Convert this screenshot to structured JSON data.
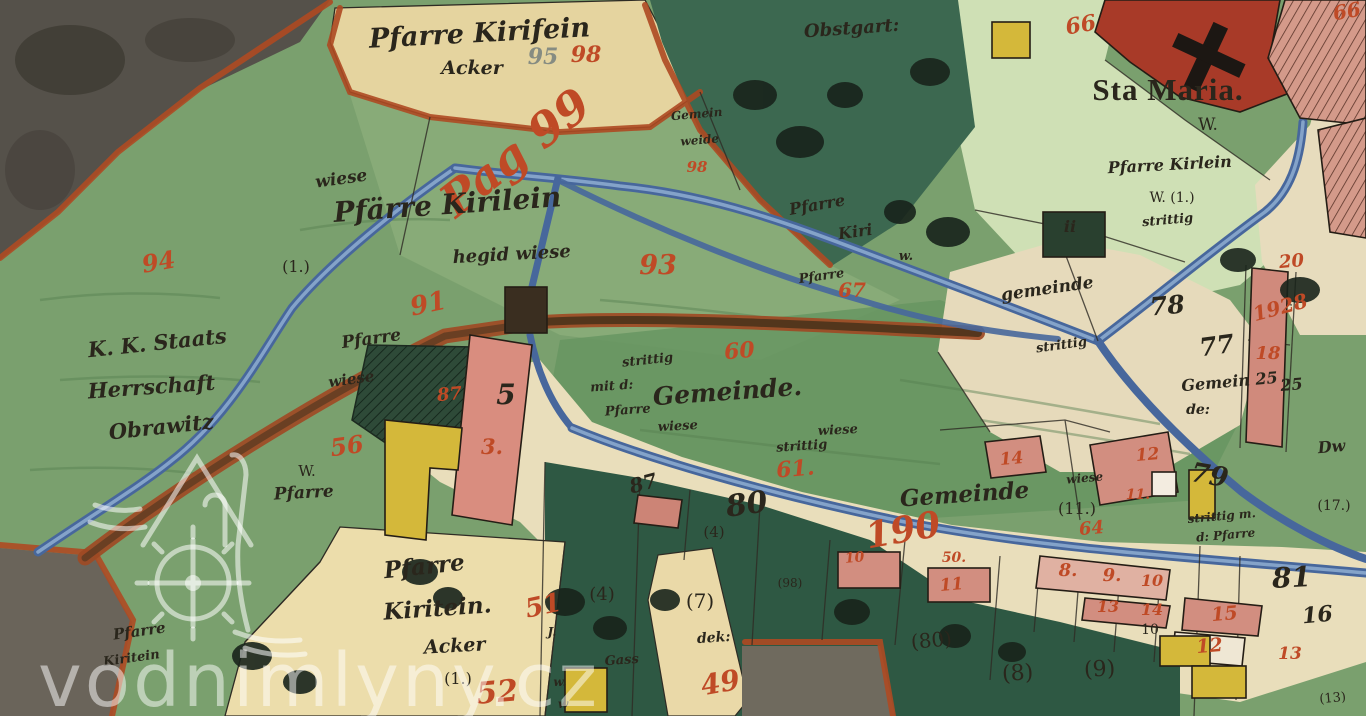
{
  "watermark": {
    "text": "vodnimlyny.cz"
  },
  "colors": {
    "ink": "#2a261c",
    "red": "#bf4a26",
    "gray": "#868c82",
    "white": "rgba(255,255,255,0.55)"
  },
  "labels": [
    {
      "t": "Pfarre Kirifein",
      "x": 480,
      "y": 42,
      "s": 27,
      "c": "ink",
      "r": -3,
      "f": "h"
    },
    {
      "t": "Acker",
      "x": 472,
      "y": 74,
      "s": 19,
      "c": "ink",
      "r": 0,
      "f": "h"
    },
    {
      "t": "95",
      "x": 543,
      "y": 64,
      "s": 22,
      "c": "gray",
      "r": 0,
      "f": "h"
    },
    {
      "t": "98",
      "x": 586,
      "y": 62,
      "s": 22,
      "c": "red",
      "r": 0,
      "f": "h"
    },
    {
      "t": "Obstgart:",
      "x": 852,
      "y": 34,
      "s": 18,
      "c": "ink",
      "r": -4,
      "f": "h"
    },
    {
      "t": "Gemein",
      "x": 697,
      "y": 118,
      "s": 12,
      "c": "ink",
      "r": -5,
      "f": "h"
    },
    {
      "t": "weide",
      "x": 700,
      "y": 144,
      "s": 12,
      "c": "ink",
      "r": -5,
      "f": "h"
    },
    {
      "t": "98",
      "x": 697,
      "y": 172,
      "s": 15,
      "c": "red",
      "r": 0,
      "f": "h"
    },
    {
      "t": "Pag 99",
      "x": 525,
      "y": 165,
      "s": 46,
      "c": "red",
      "r": -38,
      "f": "h"
    },
    {
      "t": "Sta Maria.",
      "x": 1168,
      "y": 100,
      "s": 31,
      "c": "ink",
      "r": 0,
      "f": "t"
    },
    {
      "t": "W.",
      "x": 1208,
      "y": 130,
      "s": 17,
      "c": "ink",
      "r": 0,
      "f": "p"
    },
    {
      "t": "Pfarre Kirlein",
      "x": 1170,
      "y": 170,
      "s": 16,
      "c": "ink",
      "r": -3,
      "f": "h"
    },
    {
      "t": "W. (1.)",
      "x": 1172,
      "y": 202,
      "s": 14,
      "c": "ink",
      "r": 0,
      "f": "p"
    },
    {
      "t": "strittig",
      "x": 1168,
      "y": 224,
      "s": 13,
      "c": "ink",
      "r": -5,
      "f": "h"
    },
    {
      "t": "ii",
      "x": 1070,
      "y": 232,
      "s": 16,
      "c": "ink",
      "r": 0,
      "f": "b"
    },
    {
      "t": "wiese",
      "x": 342,
      "y": 184,
      "s": 17,
      "c": "ink",
      "r": -8,
      "f": "h"
    },
    {
      "t": "Pfärre Kirilein",
      "x": 448,
      "y": 214,
      "s": 28,
      "c": "ink",
      "r": -4,
      "f": "h"
    },
    {
      "t": "(1.)",
      "x": 296,
      "y": 272,
      "s": 16,
      "c": "ink",
      "r": 0,
      "f": "p"
    },
    {
      "t": "hegid wiese",
      "x": 512,
      "y": 260,
      "s": 18,
      "c": "ink",
      "r": -3,
      "f": "h"
    },
    {
      "t": "93",
      "x": 658,
      "y": 274,
      "s": 27,
      "c": "red",
      "r": 0,
      "f": "h"
    },
    {
      "t": "Pfarre",
      "x": 818,
      "y": 210,
      "s": 16,
      "c": "ink",
      "r": -10,
      "f": "h"
    },
    {
      "t": "Kiri",
      "x": 856,
      "y": 237,
      "s": 16,
      "c": "ink",
      "r": -8,
      "f": "h"
    },
    {
      "t": "w.",
      "x": 906,
      "y": 260,
      "s": 13,
      "c": "ink",
      "r": 0,
      "f": "h"
    },
    {
      "t": "Pfarre",
      "x": 822,
      "y": 280,
      "s": 13,
      "c": "ink",
      "r": -8,
      "f": "h"
    },
    {
      "t": "67",
      "x": 852,
      "y": 297,
      "s": 20,
      "c": "red",
      "r": 0,
      "f": "h"
    },
    {
      "t": "K. K. Staats",
      "x": 158,
      "y": 350,
      "s": 21,
      "c": "ink",
      "r": -6,
      "f": "h"
    },
    {
      "t": "Herrschaft",
      "x": 152,
      "y": 394,
      "s": 21,
      "c": "ink",
      "r": -4,
      "f": "h"
    },
    {
      "t": "Obrawitz",
      "x": 162,
      "y": 434,
      "s": 21,
      "c": "ink",
      "r": -6,
      "f": "h"
    },
    {
      "t": "94",
      "x": 160,
      "y": 270,
      "s": 24,
      "c": "red",
      "r": -10,
      "f": "h"
    },
    {
      "t": "91",
      "x": 430,
      "y": 312,
      "s": 26,
      "c": "red",
      "r": -12,
      "f": "h"
    },
    {
      "t": "Pfarre",
      "x": 372,
      "y": 344,
      "s": 17,
      "c": "ink",
      "r": -8,
      "f": "h"
    },
    {
      "t": "wiese",
      "x": 352,
      "y": 384,
      "s": 15,
      "c": "ink",
      "r": -8,
      "f": "h"
    },
    {
      "t": "56",
      "x": 348,
      "y": 454,
      "s": 24,
      "c": "red",
      "r": -8,
      "f": "h"
    },
    {
      "t": "87",
      "x": 450,
      "y": 400,
      "s": 18,
      "c": "red",
      "r": -5,
      "f": "h"
    },
    {
      "t": "W.",
      "x": 307,
      "y": 476,
      "s": 15,
      "c": "ink",
      "r": 0,
      "f": "p"
    },
    {
      "t": "Pfarre",
      "x": 304,
      "y": 498,
      "s": 17,
      "c": "ink",
      "r": -3,
      "f": "h"
    },
    {
      "t": "5",
      "x": 506,
      "y": 404,
      "s": 28,
      "c": "ink",
      "r": 0,
      "f": "b"
    },
    {
      "t": "3.",
      "x": 492,
      "y": 454,
      "s": 21,
      "c": "red",
      "r": 0,
      "f": "h"
    },
    {
      "t": "strittig",
      "x": 648,
      "y": 364,
      "s": 13,
      "c": "ink",
      "r": -6,
      "f": "h"
    },
    {
      "t": "mit d:",
      "x": 612,
      "y": 390,
      "s": 13,
      "c": "ink",
      "r": -4,
      "f": "h"
    },
    {
      "t": "Gemeinde.",
      "x": 728,
      "y": 400,
      "s": 25,
      "c": "ink",
      "r": -4,
      "f": "h"
    },
    {
      "t": "Pfarre",
      "x": 628,
      "y": 414,
      "s": 13,
      "c": "ink",
      "r": -4,
      "f": "h"
    },
    {
      "t": "wiese",
      "x": 678,
      "y": 430,
      "s": 13,
      "c": "ink",
      "r": -3,
      "f": "h"
    },
    {
      "t": "wiese",
      "x": 838,
      "y": 434,
      "s": 13,
      "c": "ink",
      "r": -3,
      "f": "h"
    },
    {
      "t": "strittig",
      "x": 802,
      "y": 450,
      "s": 13,
      "c": "ink",
      "r": -4,
      "f": "h"
    },
    {
      "t": "60",
      "x": 740,
      "y": 358,
      "s": 22,
      "c": "red",
      "r": -5,
      "f": "h"
    },
    {
      "t": "61.",
      "x": 796,
      "y": 476,
      "s": 22,
      "c": "red",
      "r": -5,
      "f": "h"
    },
    {
      "t": "190",
      "x": 905,
      "y": 542,
      "s": 36,
      "c": "red",
      "r": -10,
      "f": "h"
    },
    {
      "t": "Gemeinde",
      "x": 965,
      "y": 502,
      "s": 23,
      "c": "ink",
      "r": -4,
      "f": "h"
    },
    {
      "t": "(11.)",
      "x": 1077,
      "y": 514,
      "s": 16,
      "c": "ink",
      "r": 0,
      "f": "p"
    },
    {
      "t": "wiese",
      "x": 1085,
      "y": 482,
      "s": 12,
      "c": "ink",
      "r": -5,
      "f": "h"
    },
    {
      "t": "14",
      "x": 1012,
      "y": 464,
      "s": 17,
      "c": "red",
      "r": -5,
      "f": "h"
    },
    {
      "t": "12",
      "x": 1148,
      "y": 460,
      "s": 17,
      "c": "red",
      "r": -5,
      "f": "h"
    },
    {
      "t": "11.",
      "x": 1138,
      "y": 499,
      "s": 14,
      "c": "red",
      "r": 0,
      "f": "h"
    },
    {
      "t": "79",
      "x": 1208,
      "y": 484,
      "s": 27,
      "c": "ink",
      "r": 10,
      "f": "b"
    },
    {
      "t": "strittig m.",
      "x": 1222,
      "y": 520,
      "s": 12,
      "c": "ink",
      "r": -5,
      "f": "h"
    },
    {
      "t": "d: Pfarre",
      "x": 1226,
      "y": 539,
      "s": 12,
      "c": "ink",
      "r": -5,
      "f": "h"
    },
    {
      "t": "gemeinde",
      "x": 1048,
      "y": 294,
      "s": 17,
      "c": "ink",
      "r": -8,
      "f": "h"
    },
    {
      "t": "78",
      "x": 1168,
      "y": 314,
      "s": 25,
      "c": "ink",
      "r": -5,
      "f": "b"
    },
    {
      "t": "strittig",
      "x": 1062,
      "y": 349,
      "s": 13,
      "c": "ink",
      "r": -8,
      "f": "h"
    },
    {
      "t": "77",
      "x": 1218,
      "y": 354,
      "s": 25,
      "c": "ink",
      "r": -8,
      "f": "b"
    },
    {
      "t": "Gemein 25",
      "x": 1230,
      "y": 387,
      "s": 16,
      "c": "ink",
      "r": -5,
      "f": "h"
    },
    {
      "t": "de:",
      "x": 1198,
      "y": 414,
      "s": 14,
      "c": "ink",
      "r": 0,
      "f": "h"
    },
    {
      "t": "1928",
      "x": 1282,
      "y": 314,
      "s": 20,
      "c": "red",
      "r": -15,
      "f": "h"
    },
    {
      "t": "18",
      "x": 1268,
      "y": 359,
      "s": 18,
      "c": "red",
      "r": 0,
      "f": "h"
    },
    {
      "t": "20",
      "x": 1292,
      "y": 267,
      "s": 18,
      "c": "red",
      "r": -5,
      "f": "h"
    },
    {
      "t": "25",
      "x": 1292,
      "y": 390,
      "s": 16,
      "c": "ink",
      "r": -5,
      "f": "h"
    },
    {
      "t": "Dw",
      "x": 1332,
      "y": 452,
      "s": 16,
      "c": "ink",
      "r": -5,
      "f": "h"
    },
    {
      "t": "(17.)",
      "x": 1334,
      "y": 510,
      "s": 14,
      "c": "ink",
      "r": 0,
      "f": "p"
    },
    {
      "t": "80",
      "x": 748,
      "y": 514,
      "s": 30,
      "c": "ink",
      "r": -8,
      "f": "b"
    },
    {
      "t": "(4)",
      "x": 714,
      "y": 537,
      "s": 15,
      "c": "ink",
      "r": 0,
      "f": "p"
    },
    {
      "t": "87",
      "x": 645,
      "y": 490,
      "s": 20,
      "c": "ink",
      "r": -15,
      "f": "b"
    },
    {
      "t": "Pfarre",
      "x": 425,
      "y": 574,
      "s": 23,
      "c": "ink",
      "r": -6,
      "f": "h"
    },
    {
      "t": "Kiritein.",
      "x": 438,
      "y": 616,
      "s": 23,
      "c": "ink",
      "r": -4,
      "f": "h"
    },
    {
      "t": "Acker",
      "x": 455,
      "y": 652,
      "s": 19,
      "c": "ink",
      "r": -3,
      "f": "h"
    },
    {
      "t": "(1.)",
      "x": 458,
      "y": 684,
      "s": 16,
      "c": "ink",
      "r": 0,
      "f": "p"
    },
    {
      "t": "51",
      "x": 545,
      "y": 614,
      "s": 26,
      "c": "red",
      "r": -12,
      "f": "h"
    },
    {
      "t": "52",
      "x": 498,
      "y": 702,
      "s": 30,
      "c": "red",
      "r": -5,
      "f": "h"
    },
    {
      "t": "Pfarre",
      "x": 140,
      "y": 636,
      "s": 15,
      "c": "ink",
      "r": -8,
      "f": "h"
    },
    {
      "t": "Kiritein",
      "x": 132,
      "y": 662,
      "s": 13,
      "c": "ink",
      "r": -8,
      "f": "h"
    },
    {
      "t": "(4)",
      "x": 602,
      "y": 600,
      "s": 18,
      "c": "ink",
      "r": 0,
      "f": "p"
    },
    {
      "t": "(7)",
      "x": 700,
      "y": 608,
      "s": 20,
      "c": "ink",
      "r": 0,
      "f": "p"
    },
    {
      "t": "dek:",
      "x": 714,
      "y": 642,
      "s": 14,
      "c": "ink",
      "r": -4,
      "f": "h"
    },
    {
      "t": "49",
      "x": 722,
      "y": 692,
      "s": 28,
      "c": "red",
      "r": -10,
      "f": "h"
    },
    {
      "t": "J.",
      "x": 552,
      "y": 636,
      "s": 12,
      "c": "ink",
      "r": 0,
      "f": "h"
    },
    {
      "t": "w.",
      "x": 560,
      "y": 686,
      "s": 12,
      "c": "ink",
      "r": 0,
      "f": "h"
    },
    {
      "t": "Gass",
      "x": 622,
      "y": 664,
      "s": 13,
      "c": "ink",
      "r": -4,
      "f": "h"
    },
    {
      "t": "(98)",
      "x": 790,
      "y": 587,
      "s": 12,
      "c": "ink",
      "r": 0,
      "f": "p"
    },
    {
      "t": "(80)",
      "x": 932,
      "y": 647,
      "s": 20,
      "c": "ink",
      "r": -5,
      "f": "p"
    },
    {
      "t": "(8)",
      "x": 1018,
      "y": 680,
      "s": 22,
      "c": "ink",
      "r": -3,
      "f": "p"
    },
    {
      "t": "(9)",
      "x": 1100,
      "y": 676,
      "s": 22,
      "c": "ink",
      "r": -3,
      "f": "p"
    },
    {
      "t": "10",
      "x": 1150,
      "y": 634,
      "s": 14,
      "c": "ink",
      "r": 0,
      "f": "p"
    },
    {
      "t": "8.",
      "x": 1068,
      "y": 576,
      "s": 18,
      "c": "red",
      "r": 0,
      "f": "h"
    },
    {
      "t": "9.",
      "x": 1112,
      "y": 581,
      "s": 18,
      "c": "red",
      "r": 0,
      "f": "h"
    },
    {
      "t": "10",
      "x": 1152,
      "y": 586,
      "s": 16,
      "c": "red",
      "r": 0,
      "f": "h"
    },
    {
      "t": "13",
      "x": 1108,
      "y": 612,
      "s": 16,
      "c": "red",
      "r": 0,
      "f": "h"
    },
    {
      "t": "14",
      "x": 1152,
      "y": 615,
      "s": 16,
      "c": "red",
      "r": 0,
      "f": "h"
    },
    {
      "t": "15",
      "x": 1225,
      "y": 620,
      "s": 19,
      "c": "red",
      "r": -5,
      "f": "h"
    },
    {
      "t": "12",
      "x": 1210,
      "y": 652,
      "s": 19,
      "c": "red",
      "r": -5,
      "f": "h"
    },
    {
      "t": "50.",
      "x": 954,
      "y": 562,
      "s": 14,
      "c": "red",
      "r": 0,
      "f": "h"
    },
    {
      "t": "11",
      "x": 952,
      "y": 590,
      "s": 17,
      "c": "red",
      "r": -5,
      "f": "h"
    },
    {
      "t": "10",
      "x": 855,
      "y": 562,
      "s": 14,
      "c": "red",
      "r": -5,
      "f": "h"
    },
    {
      "t": "64",
      "x": 1092,
      "y": 534,
      "s": 18,
      "c": "red",
      "r": -5,
      "f": "h"
    },
    {
      "t": "81",
      "x": 1292,
      "y": 587,
      "s": 28,
      "c": "ink",
      "r": -3,
      "f": "b"
    },
    {
      "t": "16",
      "x": 1318,
      "y": 622,
      "s": 22,
      "c": "ink",
      "r": -5,
      "f": "b"
    },
    {
      "t": "13",
      "x": 1290,
      "y": 659,
      "s": 17,
      "c": "red",
      "r": 0,
      "f": "h"
    },
    {
      "t": "66",
      "x": 1082,
      "y": 32,
      "s": 22,
      "c": "red",
      "r": -10,
      "f": "h"
    },
    {
      "t": "66",
      "x": 1348,
      "y": 18,
      "s": 20,
      "c": "red",
      "r": -10,
      "f": "h"
    },
    {
      "t": "w",
      "x": 563,
      "y": 708,
      "s": 12,
      "c": "ink",
      "r": 0,
      "f": "h"
    },
    {
      "t": "(13)",
      "x": 1333,
      "y": 702,
      "s": 13,
      "c": "ink",
      "r": -5,
      "f": "p"
    }
  ]
}
